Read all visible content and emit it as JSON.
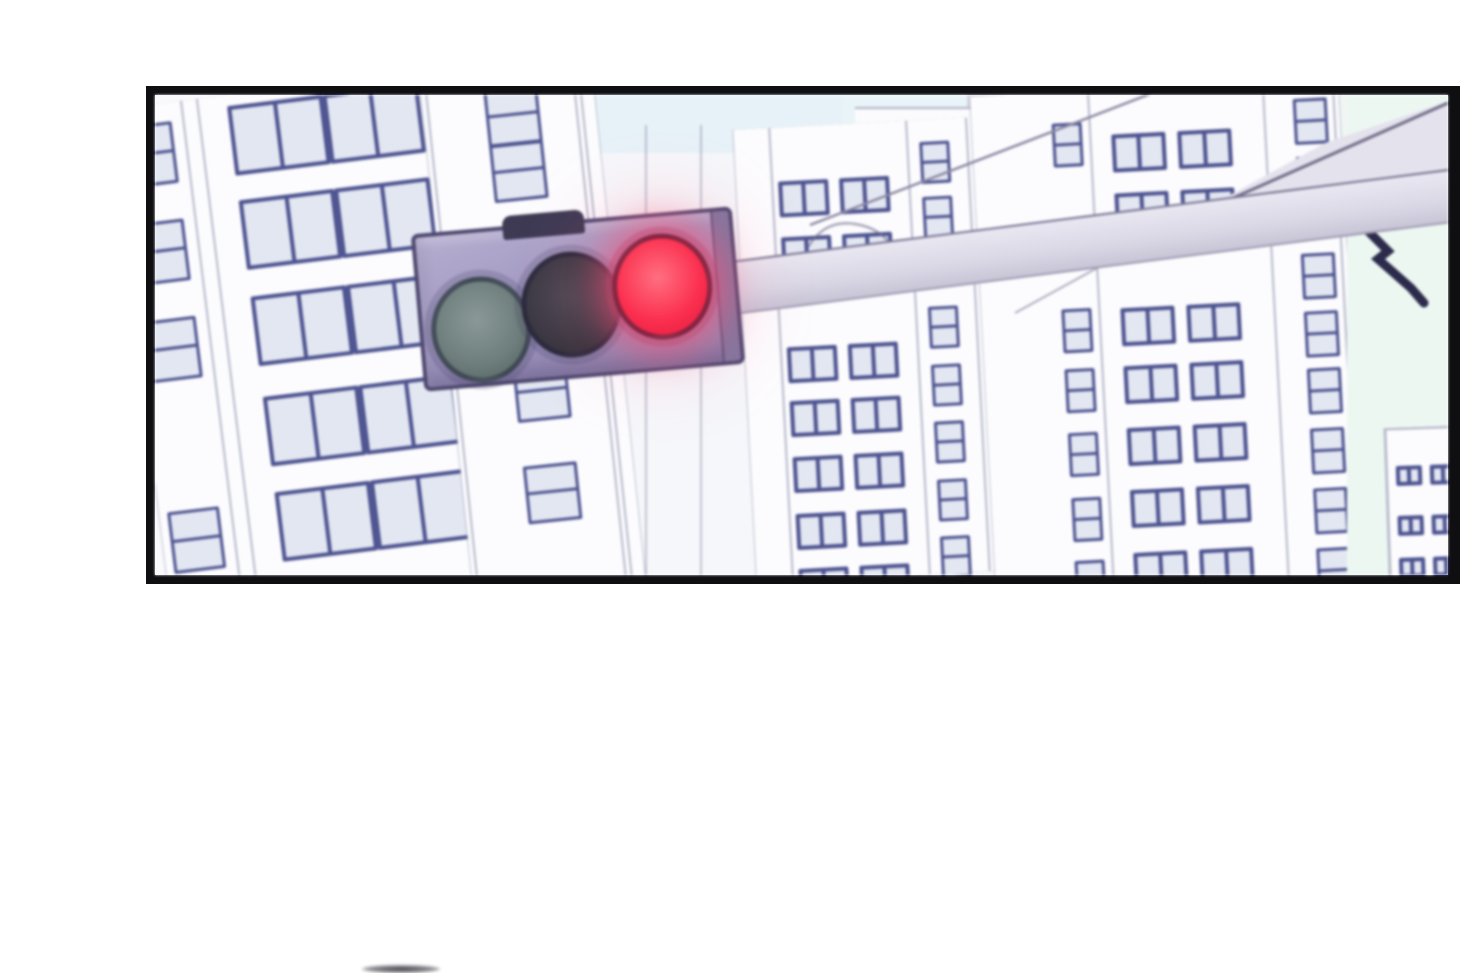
{
  "meta": {
    "kind": "comic-panel",
    "description": "Blurred anime-style cityscape panel: a horizontal traffic signal on an overhead arm shows a lit red light; white high-rise buildings with blue-framed windows fill the background; pale sky visible between rooftops; black panel border on white page; a faint edge of the next panel's artwork peeks at the bottom of the page."
  },
  "palette": {
    "page_background": "#ffffff",
    "panel_border": "#0f0f12",
    "building_fill": "#fcfcfe",
    "window_frame": "#4c528f",
    "window_pane": "#e3e7f2",
    "sky_blue": "#e7f2f8",
    "sky_green": "#edf7f2",
    "arm_gray": "#dcd9e7",
    "housing_lavender": "#9c93bd",
    "housing_outline": "#4e4870",
    "zigzag_mark": "#2c2b4b"
  },
  "traffic_light": {
    "state": "red",
    "orientation": "horizontal",
    "lights": [
      {
        "id": "green",
        "state": "off",
        "hi": "#8a9997",
        "core": "#6d7e7c",
        "lo": "#55615f"
      },
      {
        "id": "yellow",
        "state": "off",
        "hi": "#4a4853",
        "core": "#3b3944",
        "lo": "#2e2c35"
      },
      {
        "id": "red",
        "state": "on",
        "hi": "#ff6f80",
        "core": "#fb2e4e",
        "lo": "#e01d40",
        "glow": "rgba(248,80,120,0.55)"
      }
    ]
  },
  "scene": {
    "sky_patches": [
      {
        "name": "sky-top-middle",
        "x": 430,
        "y": 0,
        "w": 330,
        "h": 58,
        "fill": "#e7f2f8",
        "z": 1
      },
      {
        "name": "sky-mid-gap",
        "x": 688,
        "y": 0,
        "w": 132,
        "h": 46,
        "fill": "#e9f4f8",
        "z": 1
      },
      {
        "name": "sky-right",
        "x": 1192,
        "y": 0,
        "w": 104,
        "h": 480,
        "fill": "#edf7f2",
        "z": 3
      }
    ],
    "standalone_lines": [
      {
        "x": 490
      },
      {
        "x": 545
      }
    ],
    "blocks": [
      {
        "name": "rooftop-block",
        "x": 812,
        "y": -2,
        "w": 70,
        "h": 26,
        "fill": "#d8d5e2",
        "z": 2
      },
      {
        "name": "roof-step",
        "x": 700,
        "y": 12,
        "w": 130,
        "h": 30,
        "fill": "#fbfbfd",
        "top": true,
        "z": 2
      }
    ],
    "buildings": [
      {
        "name": "left-tower",
        "x": -16,
        "y": -16,
        "w": 470,
        "h": 512,
        "rotate": -7,
        "z": 2,
        "lines": [
          71,
          87
        ],
        "windows": [
          {
            "xs": [
              8
            ],
            "w": 52,
            "h": 62,
            "div": "h",
            "sm": true,
            "ys": [
              19,
              117,
              215,
              407
            ]
          },
          {
            "xs": [
              117,
              213
            ],
            "w": 96,
            "h": 70,
            "div": "v",
            "ys": [
              11,
              106,
              203,
              304,
              400
            ]
          }
        ]
      },
      {
        "name": "mid-column",
        "x": 292,
        "y": -16,
        "w": 172,
        "h": 512,
        "rotate": -6,
        "z": 2,
        "lines": [
          4,
          152,
          158
        ],
        "windows": [
          {
            "xs": [
              62
            ],
            "w": 54,
            "h": 58,
            "div": "h",
            "sm": true,
            "ys": [
              7,
              63,
              284,
              386
            ]
          }
        ]
      },
      {
        "name": "center-tower",
        "x": 590,
        "y": 28,
        "w": 250,
        "h": 454,
        "rotate": -3,
        "z": 2,
        "lines": [
          35,
          172,
          232
        ],
        "windows": [
          {
            "xs": [
              42,
              103
            ],
            "w": 50,
            "h": 36,
            "div": "v",
            "ys": [
              54,
              110,
              220,
              274,
              330,
              387,
              442
            ]
          },
          {
            "xs": [
              185
            ],
            "w": 30,
            "h": 42,
            "div": "h",
            "sm": true,
            "ys": [
              22,
              77,
              187,
              245,
              302,
              360,
              417
            ]
          }
        ]
      },
      {
        "name": "right-tower",
        "x": 828,
        "y": -8,
        "w": 368,
        "h": 504,
        "rotate": -3,
        "z": 2,
        "lines": [
          117,
          292,
          362
        ],
        "windows": [
          {
            "xs": [
              80
            ],
            "w": 30,
            "h": 44,
            "div": "h",
            "sm": true,
            "ys": [
              31,
              217,
              277,
              341,
              406,
              469
            ]
          },
          {
            "xs": [
              139,
              205
            ],
            "w": 54,
            "h": 38,
            "div": "v",
            "ys": [
              45,
              104,
              219,
              277,
              339,
              401,
              464
            ]
          },
          {
            "xs": [
              322
            ],
            "w": 34,
            "h": 46,
            "div": "h",
            "sm": true,
            "ys": [
              19,
              77,
              174,
              232,
              289,
              349,
              409,
              469
            ]
          }
        ]
      },
      {
        "name": "distant-tower",
        "x": 1232,
        "y": 332,
        "w": 78,
        "h": 148,
        "rotate": -2,
        "z": 4,
        "top": true,
        "lines": [
          0
        ],
        "windows": [
          {
            "xs": [
              10,
              44
            ],
            "w": 26,
            "h": 20,
            "div": "v",
            "ys": [
              36,
              86,
              128
            ]
          }
        ]
      }
    ]
  }
}
